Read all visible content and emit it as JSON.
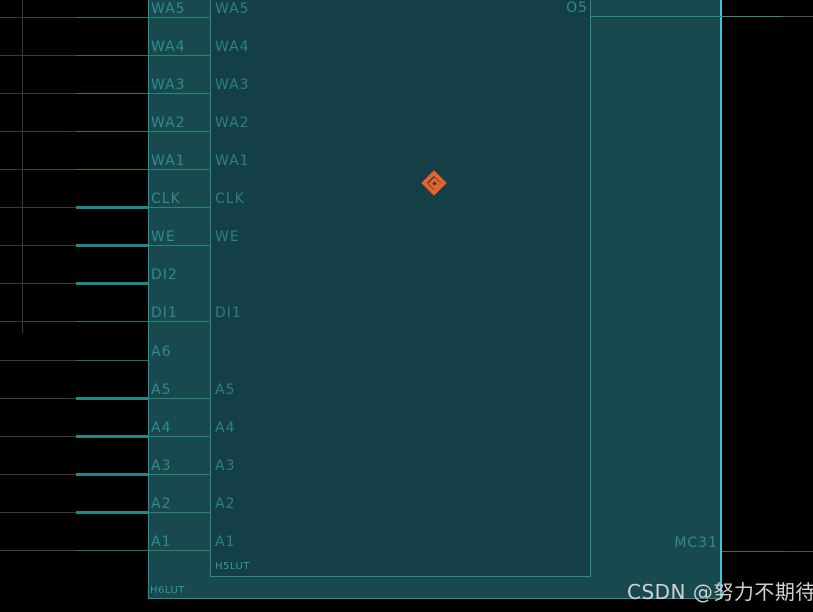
{
  "blocks": {
    "outer": {
      "type_label": "H6LUT",
      "output_pin": "MC31"
    },
    "inner": {
      "type_label": "H5LUT",
      "output_pin": "O5"
    }
  },
  "rows": [
    {
      "name": "WA5",
      "wire": "thin",
      "connects_inner": true
    },
    {
      "name": "WA4",
      "wire": "thin",
      "connects_inner": true
    },
    {
      "name": "WA3",
      "wire": "thin",
      "connects_inner": true
    },
    {
      "name": "WA2",
      "wire": "thin",
      "connects_inner": true
    },
    {
      "name": "WA1",
      "wire": "thin",
      "connects_inner": true
    },
    {
      "name": "CLK",
      "wire": "thick",
      "connects_inner": true
    },
    {
      "name": "WE",
      "wire": "thick",
      "connects_inner": true
    },
    {
      "name": "DI2",
      "wire": "thick",
      "connects_inner": false
    },
    {
      "name": "DI1",
      "wire": "thin",
      "connects_inner": true
    },
    {
      "name": "A6",
      "wire": "thin",
      "connects_inner": false
    },
    {
      "name": "A5",
      "wire": "thick",
      "connects_inner": true
    },
    {
      "name": "A4",
      "wire": "thick",
      "connects_inner": true
    },
    {
      "name": "A3",
      "wire": "thick",
      "connects_inner": true
    },
    {
      "name": "A2",
      "wire": "thick",
      "connects_inner": true
    },
    {
      "name": "A1",
      "wire": "thin",
      "connects_inner": true
    }
  ],
  "marker": {
    "type": "selection-diamond",
    "color": "#e8622a"
  },
  "watermark": {
    "text": "CSDN @努力不期待",
    "color": "#d0d0d0"
  },
  "colors": {
    "canvas_bg": "#000000",
    "outer_cell_fill": "#17494e",
    "inner_cell_fill": "#143f46",
    "cell_border": "#2d9091",
    "selected_edge": "#3fc4da",
    "net_thin_green": "#20794d",
    "net_thick_teal": "#1d8888",
    "net_offpage_gray": "#4a5050",
    "pin_text": "#2e8c8e"
  }
}
